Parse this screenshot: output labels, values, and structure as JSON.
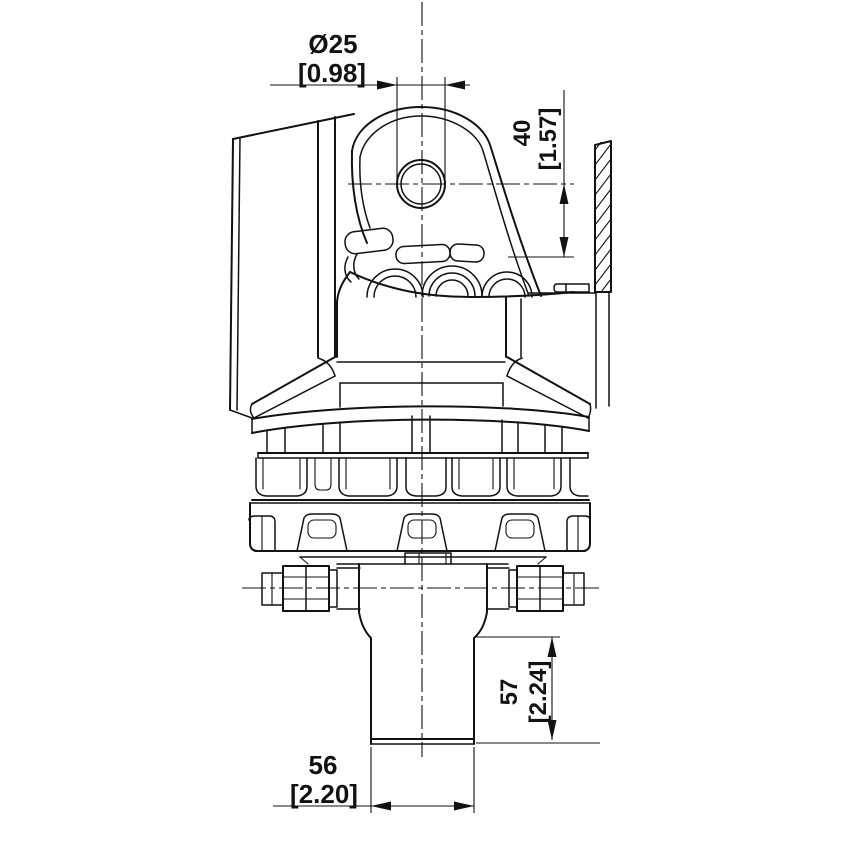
{
  "meta": {
    "title": "Hydraulic rotator - front view technical drawing",
    "background_color": "#ffffff",
    "line_color": "#121212"
  },
  "dimensions": {
    "hole_diameter": {
      "mm": "Ø25",
      "inch": "[0.98]"
    },
    "eye_to_frame": {
      "mm": "40",
      "inch": "[1.57]"
    },
    "shaft_length": {
      "mm": "57",
      "inch": "[2.24]"
    },
    "shaft_width": {
      "mm": "56",
      "inch": "[2.20]"
    }
  }
}
